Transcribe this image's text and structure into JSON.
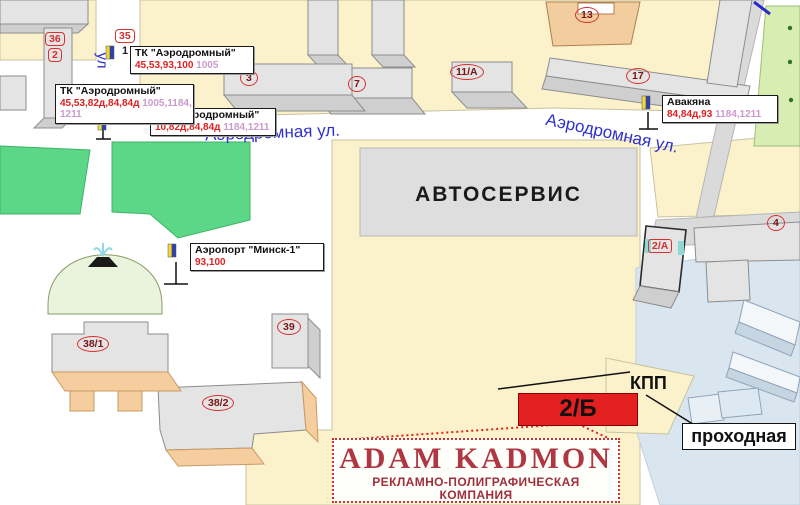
{
  "colors": {
    "accent_red": "#E02020",
    "street_blue": "#2F2FD0",
    "gray_numbers": "#CC99CC",
    "highlight_red": "#E41F1F",
    "ad_red": "#B03642",
    "park_green": "#5CD687",
    "block_yellow": "#FBF2CC"
  },
  "streets": {
    "left": "Аэродромная ул.",
    "right": "Аэродромная ул.",
    "vertical_fragment": "ул"
  },
  "areas": {
    "avtoservis": "АВТОСЕРВИС"
  },
  "callouts": [
    {
      "title": "ТК \"Аэродромный\"",
      "red": "45,53,93,100",
      "gray": "1005"
    },
    {
      "title": "ТК \"Аэродромный\"",
      "red": "45,53,82д,84,84д",
      "gray": "1005,1184,",
      "gray2": "1211"
    },
    {
      "title": "эродромный\"",
      "red": "10,82д,84,84д",
      "gray": "1184,1211"
    },
    {
      "title": "Аэропорт \"Минск-1\"",
      "red": "93,100"
    },
    {
      "title": "Авакяна",
      "red": "84,84д,93",
      "gray": "1184,1211"
    }
  ],
  "badges": {
    "b36": "36",
    "b2": "2",
    "b35": "35",
    "b1": "1"
  },
  "buildings": {
    "b3": "3",
    "b7": "7",
    "b11a": "11/А",
    "b13": "13",
    "b17": "17",
    "b4": "4",
    "b2a": "2/А",
    "b39": "39",
    "b381": "38/1",
    "b382": "38/2"
  },
  "gate": {
    "highlight": "2/Б",
    "kpp": "КПП",
    "prohodnaya": "проходная"
  },
  "ad": {
    "title": "ADAM KADMON",
    "subtitle1": "РЕКЛАМНО-ПОЛИГРАФИЧЕСКАЯ",
    "subtitle2": "КОМПАНИЯ"
  }
}
